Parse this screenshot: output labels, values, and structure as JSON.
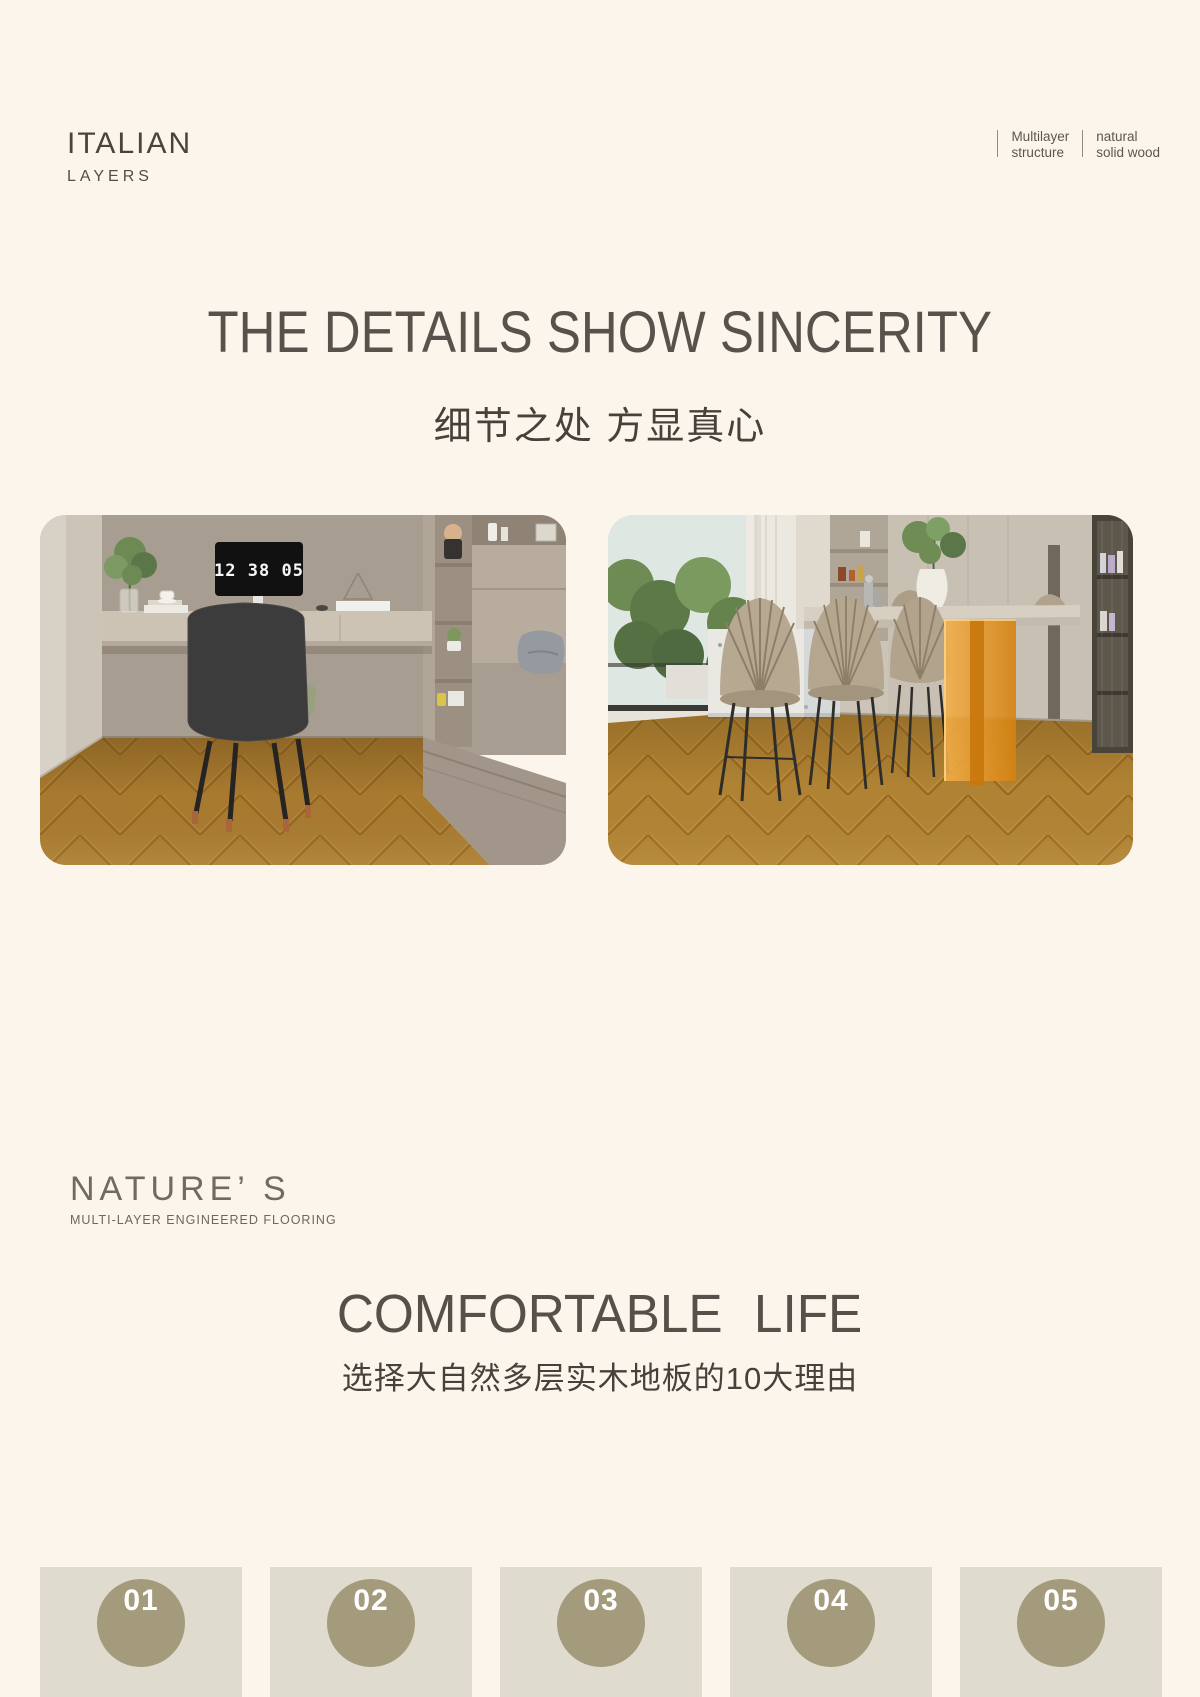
{
  "colors": {
    "page_background": "#fcf5eb",
    "heading_text": "#57534c",
    "body_text": "#46423b",
    "card_background": "#dfdbce",
    "badge_background": "#a49a7c",
    "badge_number_text": "#ffffff",
    "floor_wood": "#a87a30"
  },
  "header": {
    "brand_title": "ITALIAN",
    "brand_subtitle": "LAYERS",
    "tags": [
      {
        "line1": "Multilayer",
        "line2": "structure"
      },
      {
        "line1": "natural",
        "line2": "solid wood"
      }
    ]
  },
  "section_details": {
    "heading_en": "THE DETAILS SHOW SINCERITY",
    "heading_zh": "细节之处 方显真心",
    "clock_time": "12 38 05"
  },
  "section_comfort": {
    "brand_title": "NATURE’ S",
    "brand_subtitle": "MULTI-LAYER ENGINEERED FLOORING",
    "heading_en": "COMFORTABLE LIFE",
    "heading_zh": "选择大自然多层实木地板的10大理由",
    "reason_cards": [
      {
        "number": "01"
      },
      {
        "number": "02"
      },
      {
        "number": "03"
      },
      {
        "number": "04"
      },
      {
        "number": "05"
      }
    ]
  }
}
